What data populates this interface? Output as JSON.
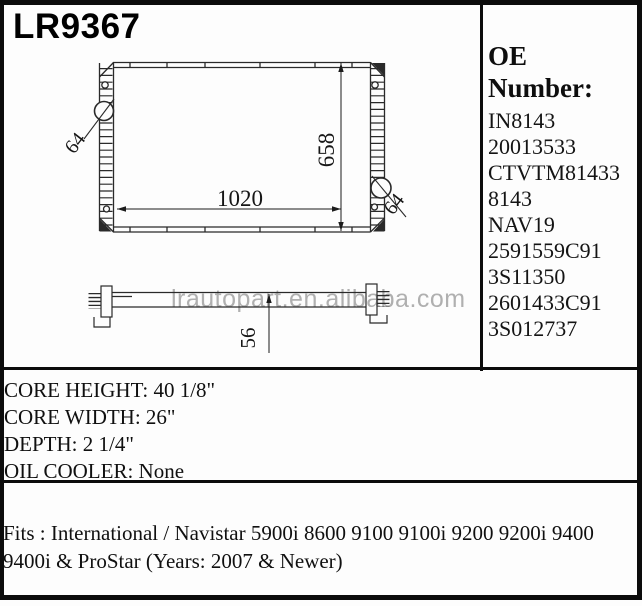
{
  "title": {
    "part_number": "LR9367"
  },
  "oe_panel": {
    "heading": "OE Number:",
    "numbers": [
      "IN8143",
      "20013533",
      "CTVTM81433",
      "8143",
      "NAV19",
      "2591559C91",
      "3S11350",
      "2601433C91",
      "3S012737"
    ]
  },
  "drawing": {
    "watermark": "lrautopart.en.alibaba.com",
    "front_view": {
      "core_width_label": "1020",
      "core_height_label": "658",
      "left_port_label": "64",
      "right_port_label": "64"
    },
    "side_view": {
      "depth_label": "56"
    }
  },
  "specs": {
    "lines": [
      "CORE HEIGHT: 40 1/8\"",
      "CORE WIDTH: 26\"",
      "DEPTH: 2 1/4\"",
      "OIL COOLER: None"
    ]
  },
  "fitment": {
    "line1": "Fits : International / Navistar 5900i 8600 9100 9100i 9200 9200i 9400",
    "line2": "9400i & ProStar (Years: 2007 & Newer)"
  },
  "colors": {
    "background": "#fdfdfd",
    "border": "#0c0c0c",
    "line": "#2a2a2a",
    "text": "#101010",
    "watermark": "#b0b0b0"
  }
}
